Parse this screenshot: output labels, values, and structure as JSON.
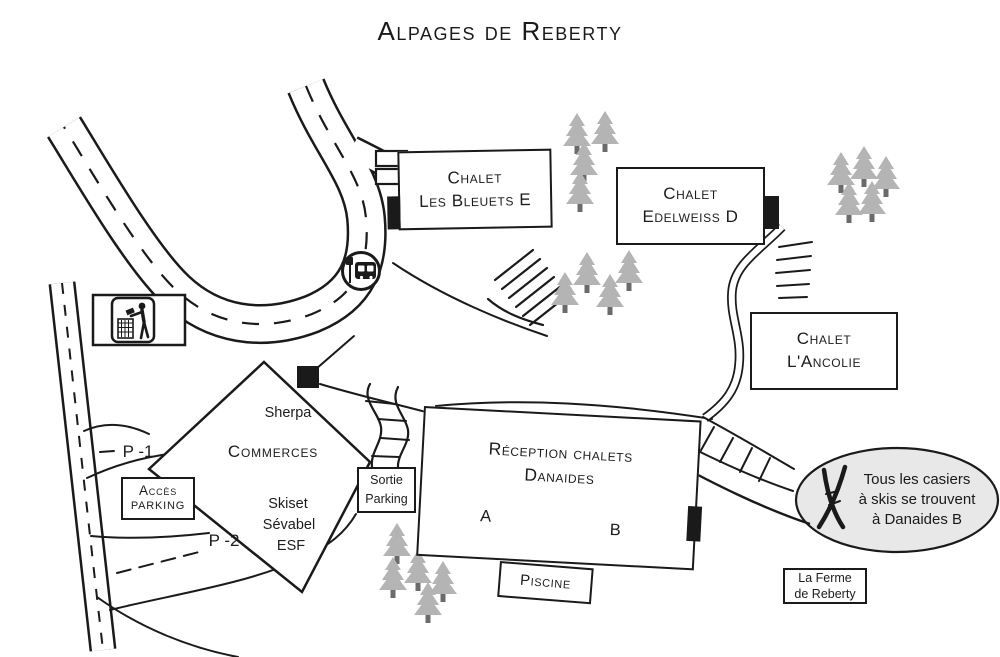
{
  "title": "Alpages de Reberty",
  "buildings": {
    "bleuets": {
      "line1": "Chalet",
      "line2": "Les Bleuets E"
    },
    "edelweiss": {
      "line1": "Chalet",
      "line2": "Edelweiss D"
    },
    "ancolie": {
      "line1": "Chalet",
      "line2": "L'Ancolie"
    },
    "reception": {
      "line1": "Réception chalets",
      "line2": "Danaides",
      "unit_a": "A",
      "unit_b": "B"
    },
    "piscine": {
      "label": "Piscine"
    },
    "ferme": {
      "line1": "La Ferme",
      "line2": "de Reberty"
    }
  },
  "commerces": {
    "top": "Sherpa",
    "title": "Commerces",
    "shop1": "Skiset",
    "shop2": "Sévabel",
    "shop3": "ESF"
  },
  "parking": {
    "acces_line1": "Accès",
    "acces_line2": "Parking",
    "sortie_line1": "Sortie",
    "sortie_line2": "Parking",
    "level1": "P -1",
    "level2": "P -2"
  },
  "bubble": {
    "line1": "Tous les casiers",
    "line2": "à skis se trouvent",
    "line3": "à Danaides B"
  },
  "icons": {
    "trash": "trash-disposal-icon",
    "bus": "bus-stop-icon",
    "skis": "crossed-skis-icon"
  },
  "colors": {
    "line": "#1a1a1a",
    "tree_fill": "#b4b4b4",
    "tree_trunk": "#6b6b6b",
    "bubble_fill": "#e8e8e8"
  }
}
